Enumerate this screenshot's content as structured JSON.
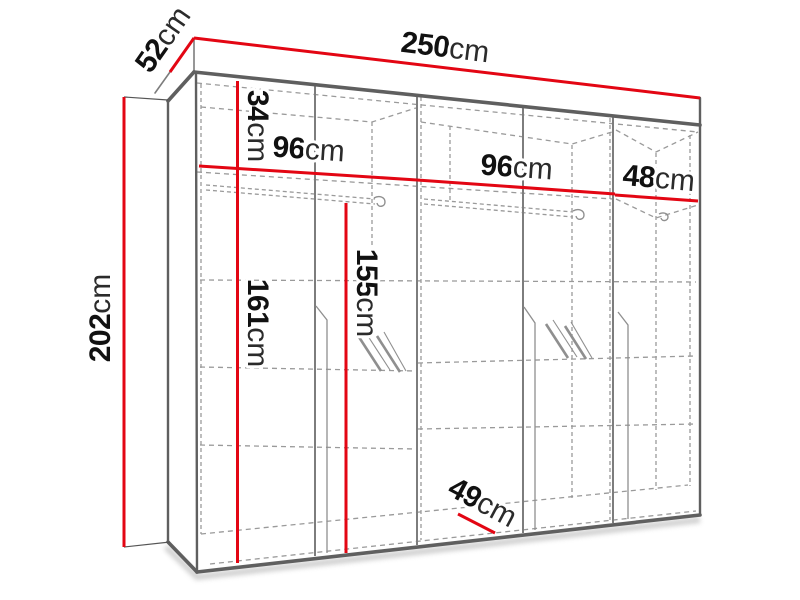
{
  "dimensions": {
    "width": {
      "value": "250",
      "unit": "cm"
    },
    "depth": {
      "value": "52",
      "unit": "cm"
    },
    "height": {
      "value": "202",
      "unit": "cm"
    },
    "top_compartment": {
      "value": "34",
      "unit": "cm"
    },
    "section_left": {
      "value": "96",
      "unit": "cm"
    },
    "section_middle": {
      "value": "96",
      "unit": "cm"
    },
    "section_right": {
      "value": "48",
      "unit": "cm"
    },
    "interior_left_height": {
      "value": "161",
      "unit": "cm"
    },
    "interior_rail_height": {
      "value": "155",
      "unit": "cm"
    },
    "interior_depth": {
      "value": "49",
      "unit": "cm"
    }
  },
  "colors": {
    "dimension_red": "#e30613",
    "edge_dark": "#5f5f5f",
    "line_gray": "#7d7d7d",
    "dashed_gray": "#9a9a9a",
    "background": "#ffffff",
    "shadow": "#c8c8c8"
  }
}
